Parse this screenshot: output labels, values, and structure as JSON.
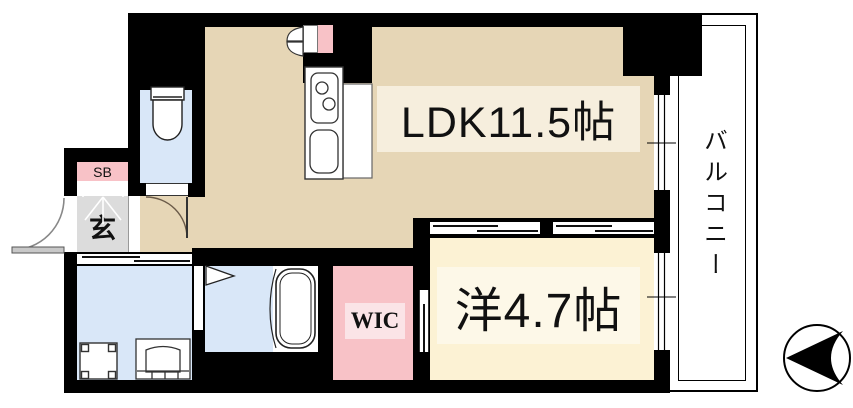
{
  "rooms": {
    "ldk": {
      "label": "LDK11.5帖"
    },
    "western_room": {
      "label": "洋4.7帖"
    },
    "wic": {
      "label": "WIC"
    },
    "genkan": {
      "label": "玄"
    },
    "shoe_box": {
      "label": "SB"
    },
    "balcony": {
      "label": "バルコニー"
    }
  },
  "colors": {
    "wall": "#000000",
    "ldk-floor": "#e6d6b6",
    "ldk-band": "#f6eedd",
    "western-floor": "#fcf2d4",
    "western-band": "#fdf8e8",
    "wet-blue": "#d9e7f8",
    "pink": "#f8c2c7",
    "pink-band": "#fbe4e7",
    "genkan-gray": "#dcdcdc",
    "outline": "#222222"
  }
}
